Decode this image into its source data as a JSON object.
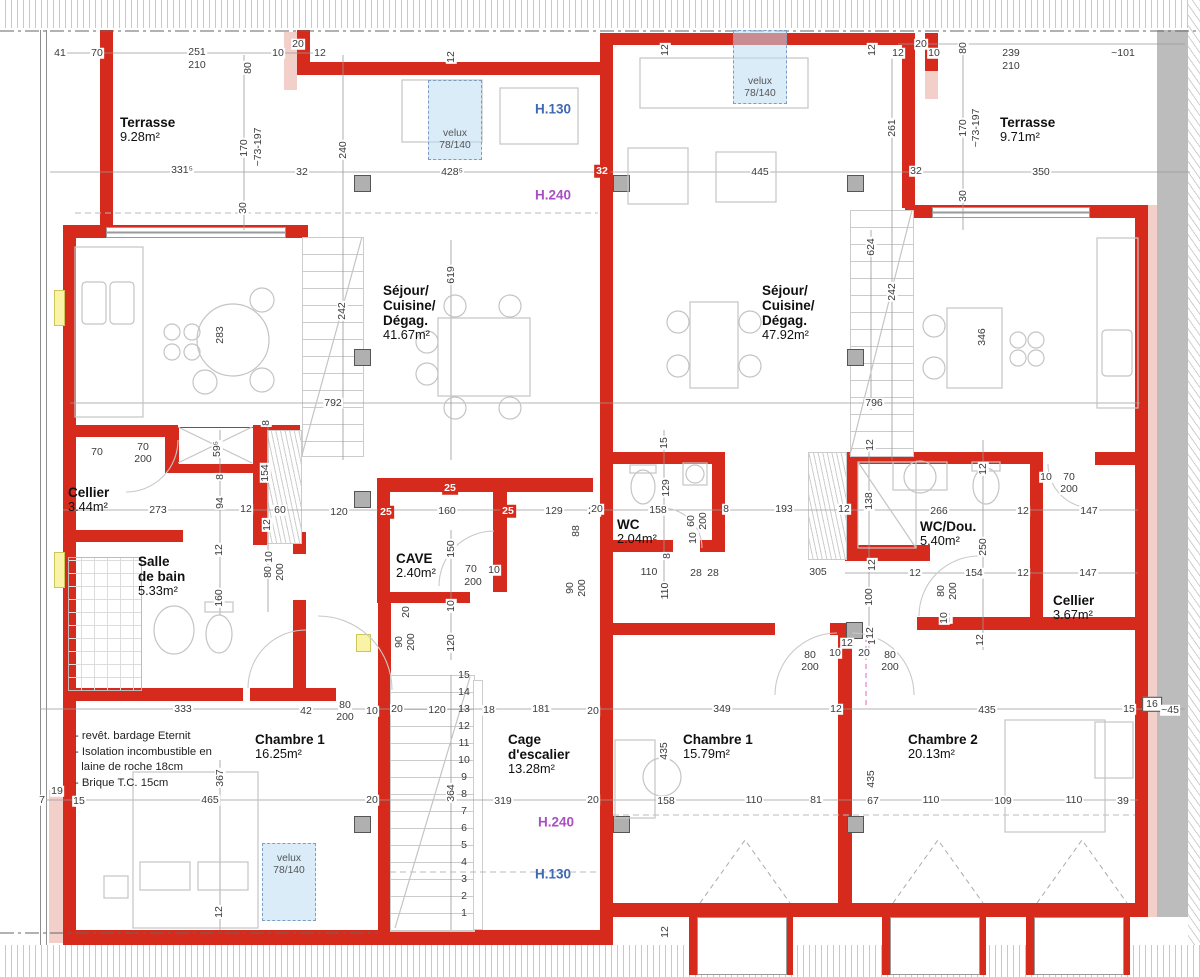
{
  "palette": {
    "wall_red": "#d62a1c",
    "wall_pink": "#f2cfc9",
    "velux_blue": "#bddcf4",
    "h130_blue": "#3f68b5",
    "h240_purple": "#a94fc4",
    "dim_text": "#3a3a3a",
    "band_gray": "#bcbcbc"
  },
  "rooms": [
    {
      "x": 120,
      "y": 115,
      "lines": [
        "Terrasse"
      ],
      "area": "9.28m²"
    },
    {
      "x": 1000,
      "y": 115,
      "lines": [
        "Terrasse"
      ],
      "area": "9.71m²"
    },
    {
      "x": 383,
      "y": 283,
      "lines": [
        "Séjour/",
        "Cuisine/",
        "Dégag."
      ],
      "area": "41.67m²"
    },
    {
      "x": 762,
      "y": 283,
      "lines": [
        "Séjour/",
        "Cuisine/",
        "Dégag."
      ],
      "area": "47.92m²"
    },
    {
      "x": 68,
      "y": 485,
      "lines": [
        "Cellier"
      ],
      "area": "3.44m²"
    },
    {
      "x": 138,
      "y": 554,
      "lines": [
        "Salle",
        "de bain"
      ],
      "area": "5.33m²"
    },
    {
      "x": 396,
      "y": 551,
      "lines": [
        "CAVE"
      ],
      "area": "2.40m²"
    },
    {
      "x": 617,
      "y": 517,
      "lines": [
        "WC"
      ],
      "area": "2.04m²"
    },
    {
      "x": 920,
      "y": 519,
      "lines": [
        "WC/Dou."
      ],
      "area": "5.40m²"
    },
    {
      "x": 1053,
      "y": 593,
      "lines": [
        "Cellier"
      ],
      "area": "3.67m²"
    },
    {
      "x": 255,
      "y": 732,
      "lines": [
        "Chambre 1"
      ],
      "area": "16.25m²"
    },
    {
      "x": 508,
      "y": 732,
      "lines": [
        "Cage",
        "d'escalier"
      ],
      "area": "13.28m²"
    },
    {
      "x": 683,
      "y": 732,
      "lines": [
        "Chambre 1"
      ],
      "area": "15.79m²"
    },
    {
      "x": 908,
      "y": 732,
      "lines": [
        "Chambre 2"
      ],
      "area": "20.13m²"
    }
  ],
  "height_labels": [
    {
      "t": "H.130",
      "x": 553,
      "y": 109,
      "c": "blue"
    },
    {
      "t": "H.240",
      "x": 553,
      "y": 195,
      "c": "purple"
    },
    {
      "t": "H.240",
      "x": 556,
      "y": 822,
      "c": "purple"
    },
    {
      "t": "H.130",
      "x": 553,
      "y": 874,
      "c": "blue"
    }
  ],
  "velux": [
    {
      "x": 428,
      "y": 80,
      "w": 52,
      "h": 78,
      "t1": "velux",
      "t2": "78/140",
      "oy1": 48,
      "oy2": 60
    },
    {
      "x": 733,
      "y": 30,
      "w": 52,
      "h": 72,
      "t1": "velux",
      "t2": "78/140",
      "oy1": 46,
      "oy2": 58
    },
    {
      "x": 262,
      "y": 843,
      "w": 52,
      "h": 76,
      "t1": "velux",
      "t2": "78/140",
      "oy1": 10,
      "oy2": 22
    }
  ],
  "notes": {
    "x": 75,
    "y": 729,
    "lines": [
      "- revêt. bardage Eternit",
      "- Isolation incombustible en",
      "  laine de roche 18cm",
      "- Brique T.C. 15cm"
    ]
  },
  "stair_numbers": {
    "x": 464,
    "start_y": 913,
    "step": 17,
    "count": 15
  },
  "dims": [
    [
      "41",
      60,
      53
    ],
    [
      "70",
      97,
      53
    ],
    [
      "251",
      197,
      52
    ],
    [
      "210",
      197,
      65
    ],
    [
      "10",
      278,
      53
    ],
    [
      "20",
      298,
      44
    ],
    [
      "12",
      320,
      53
    ],
    [
      "80",
      248,
      68,
      "v"
    ],
    [
      "170",
      244,
      148,
      "v"
    ],
    [
      "~73-197",
      258,
      147,
      "v"
    ],
    [
      "331⁵",
      182,
      170
    ],
    [
      "32",
      302,
      172
    ],
    [
      "30",
      243,
      208,
      "v"
    ],
    [
      "240",
      343,
      150,
      "v"
    ],
    [
      "12",
      451,
      57,
      "v"
    ],
    [
      "428⁵",
      452,
      172
    ],
    [
      "32",
      602,
      171,
      "w"
    ],
    [
      "12",
      665,
      50,
      "v"
    ],
    [
      "12",
      872,
      50,
      "v"
    ],
    [
      "12",
      898,
      53
    ],
    [
      "20",
      921,
      44
    ],
    [
      "261",
      892,
      128,
      "v"
    ],
    [
      "445",
      760,
      172
    ],
    [
      "32",
      916,
      171
    ],
    [
      "10",
      934,
      53
    ],
    [
      "80",
      963,
      48,
      "v"
    ],
    [
      "239",
      1011,
      53
    ],
    [
      "210",
      1011,
      66
    ],
    [
      "~101",
      1123,
      53
    ],
    [
      "170",
      963,
      128,
      "v"
    ],
    [
      "~73-197",
      976,
      128,
      "v"
    ],
    [
      "350",
      1041,
      172
    ],
    [
      "30",
      963,
      196,
      "v"
    ],
    [
      "283",
      220,
      335,
      "v"
    ],
    [
      "242",
      342,
      311,
      "v"
    ],
    [
      "619",
      451,
      275,
      "v"
    ],
    [
      "792",
      333,
      403
    ],
    [
      "624",
      871,
      247,
      "v"
    ],
    [
      "242",
      892,
      292,
      "v"
    ],
    [
      "346",
      982,
      337,
      "v"
    ],
    [
      "796",
      874,
      403
    ],
    [
      "70",
      97,
      452
    ],
    [
      "70",
      143,
      447
    ],
    [
      "200",
      143,
      459
    ],
    [
      "59⁵",
      217,
      449,
      "v"
    ],
    [
      "8",
      220,
      477,
      "v"
    ],
    [
      "8",
      266,
      423,
      "v"
    ],
    [
      "273",
      158,
      510
    ],
    [
      "94",
      220,
      503,
      "v"
    ],
    [
      "12",
      246,
      509
    ],
    [
      "60",
      280,
      510
    ],
    [
      "154",
      265,
      473,
      "v"
    ],
    [
      "12",
      267,
      525,
      "v"
    ],
    [
      "12",
      219,
      550,
      "v"
    ],
    [
      "160",
      219,
      598,
      "v"
    ],
    [
      "10",
      269,
      557,
      "v"
    ],
    [
      "80",
      268,
      572,
      "v"
    ],
    [
      "200",
      280,
      572,
      "v"
    ],
    [
      "120",
      339,
      512
    ],
    [
      "25",
      386,
      512,
      "w"
    ],
    [
      "160",
      447,
      511
    ],
    [
      "25",
      508,
      511,
      "w"
    ],
    [
      "129",
      554,
      511
    ],
    [
      "20",
      594,
      511
    ],
    [
      "25",
      450,
      488,
      "w"
    ],
    [
      "150",
      451,
      549,
      "v"
    ],
    [
      "70",
      471,
      569
    ],
    [
      "200",
      473,
      582
    ],
    [
      "10",
      494,
      570
    ],
    [
      "88",
      576,
      531,
      "v"
    ],
    [
      "90",
      570,
      588,
      "v"
    ],
    [
      "200",
      582,
      588,
      "v"
    ],
    [
      "20",
      406,
      612,
      "v"
    ],
    [
      "90",
      399,
      642,
      "v"
    ],
    [
      "200",
      411,
      642,
      "v"
    ],
    [
      "10",
      451,
      606,
      "v"
    ],
    [
      "120",
      451,
      643,
      "v"
    ],
    [
      "15",
      664,
      443,
      "v"
    ],
    [
      "129",
      666,
      488,
      "v"
    ],
    [
      "158",
      658,
      510
    ],
    [
      "60",
      691,
      521,
      "v"
    ],
    [
      "200",
      703,
      521,
      "v"
    ],
    [
      "8",
      726,
      509
    ],
    [
      "10",
      693,
      538,
      "v"
    ],
    [
      "8",
      667,
      556,
      "v"
    ],
    [
      "110",
      649,
      572
    ],
    [
      "110",
      665,
      591,
      "v"
    ],
    [
      "28",
      696,
      573
    ],
    [
      "28",
      713,
      573
    ],
    [
      "305",
      818,
      572
    ],
    [
      "193",
      784,
      509
    ],
    [
      "12",
      844,
      509
    ],
    [
      "20",
      597,
      509
    ],
    [
      "12",
      870,
      445,
      "v"
    ],
    [
      "138",
      869,
      501,
      "v"
    ],
    [
      "266",
      939,
      511
    ],
    [
      "12",
      983,
      469,
      "v"
    ],
    [
      "12",
      1023,
      511
    ],
    [
      "10",
      1046,
      477
    ],
    [
      "70",
      1069,
      477
    ],
    [
      "200",
      1069,
      489
    ],
    [
      "147",
      1089,
      511
    ],
    [
      "250",
      983,
      547,
      "v"
    ],
    [
      "12",
      872,
      565,
      "v"
    ],
    [
      "12",
      915,
      573
    ],
    [
      "154",
      974,
      573
    ],
    [
      "12",
      1023,
      573
    ],
    [
      "147",
      1088,
      573
    ],
    [
      "100",
      869,
      597,
      "v"
    ],
    [
      "80",
      941,
      591,
      "v"
    ],
    [
      "200",
      953,
      591,
      "v"
    ],
    [
      "10",
      947,
      617,
      "v"
    ],
    [
      "12",
      872,
      639,
      "v"
    ],
    [
      "12",
      980,
      640,
      "v"
    ],
    [
      "15",
      1129,
      709
    ],
    [
      "16",
      1152,
      704,
      "b"
    ],
    [
      "~45",
      1170,
      710
    ],
    [
      "333",
      183,
      709
    ],
    [
      "42",
      306,
      711
    ],
    [
      "80",
      345,
      705
    ],
    [
      "200",
      345,
      717
    ],
    [
      "10",
      372,
      711
    ],
    [
      "20",
      397,
      709
    ],
    [
      "367",
      220,
      778,
      "v"
    ],
    [
      "465",
      210,
      800
    ],
    [
      "15",
      79,
      801
    ],
    [
      "20",
      372,
      800
    ],
    [
      "7",
      42,
      800
    ],
    [
      "19",
      57,
      791
    ],
    [
      "12",
      219,
      912,
      "v"
    ],
    [
      "120",
      437,
      710
    ],
    [
      "18",
      489,
      710
    ],
    [
      "181",
      541,
      709
    ],
    [
      "20",
      593,
      711
    ],
    [
      "364",
      451,
      793,
      "v"
    ],
    [
      "319",
      503,
      801
    ],
    [
      "20",
      593,
      800
    ],
    [
      "12",
      665,
      932,
      "v"
    ],
    [
      "349",
      722,
      709
    ],
    [
      "12",
      836,
      709
    ],
    [
      "435",
      664,
      751,
      "v"
    ],
    [
      "435",
      871,
      779,
      "v"
    ],
    [
      "158",
      666,
      801
    ],
    [
      "110",
      754,
      800
    ],
    [
      "81",
      816,
      800
    ],
    [
      "67",
      873,
      801
    ],
    [
      "435",
      987,
      710
    ],
    [
      "110",
      931,
      800
    ],
    [
      "109",
      1003,
      801
    ],
    [
      "110",
      1074,
      800
    ],
    [
      "39",
      1123,
      801
    ],
    [
      "12",
      847,
      643
    ],
    [
      "80",
      810,
      655
    ],
    [
      "200",
      810,
      667
    ],
    [
      "10",
      835,
      653
    ],
    [
      "20",
      864,
      653
    ],
    [
      "80",
      890,
      655
    ],
    [
      "200",
      890,
      667
    ],
    [
      "12",
      870,
      633,
      "v"
    ],
    [
      "10",
      944,
      618,
      "v"
    ]
  ]
}
